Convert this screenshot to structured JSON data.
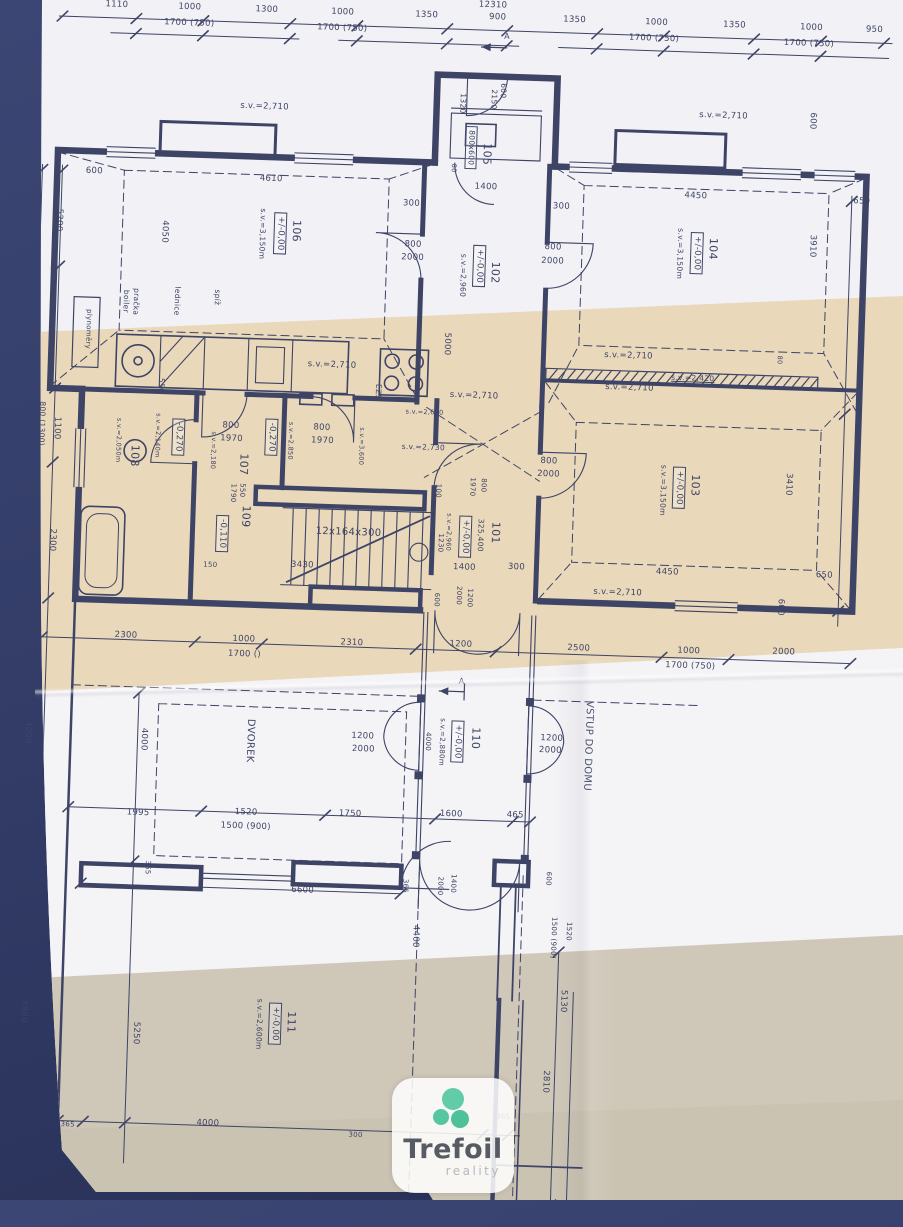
{
  "photo": {
    "background_color": "#333d68",
    "paper_color": "#f2f1f5",
    "tan_band_color": "#e9d8ba",
    "lower_band_color": "#cfc7b8",
    "ink_color": "#3e4466"
  },
  "logo": {
    "name": "Trefoil",
    "subtitle": "reality",
    "icon": "trefoil-clover-icon",
    "brand_green": "#57c8a1",
    "text_color": "#575b63",
    "subtitle_color": "#b5b8bd"
  },
  "plan": {
    "rooms": [
      {
        "number": "101",
        "level": "+/-0,00",
        "ceiling": "s.v.=2,960",
        "note": "325,400"
      },
      {
        "number": "102",
        "level": "+/-0,00",
        "ceiling": "s.v.=2,960"
      },
      {
        "number": "103",
        "level": "+/-0,00",
        "ceiling": "s.v.=3,150m"
      },
      {
        "number": "104",
        "level": "+/-0,00",
        "ceiling": "s.v.=3,150m"
      },
      {
        "number": "105",
        "fixture": "800x600"
      },
      {
        "number": "106",
        "level": "+/-0,00",
        "ceiling": "s.v.=3,150m",
        "features": [
          "boiler",
          "pračka",
          "lednice",
          "spíž"
        ]
      },
      {
        "number": "107",
        "level": "-0,270",
        "ceiling": "s.v.=2,850"
      },
      {
        "number": "108",
        "level": "-0,270",
        "ceiling": "s.v.=2,050m"
      },
      {
        "number": "109",
        "level": "-0,110",
        "stairs": "12x164x300"
      },
      {
        "number": "110",
        "level": "+/-0,00",
        "ceiling": "s.v.=2,880m"
      },
      {
        "number": "111",
        "level": "+/-0,00",
        "ceiling": "s.v.=2,600m"
      }
    ],
    "annotations": {
      "courtyard": "DVOREK",
      "entrance": "VSTUP DO DOMU",
      "gas_meters": "plynoměry",
      "alarm": "EZS",
      "stairs_formula": "12x164x300",
      "section_mark": "A",
      "total_width": "12310"
    },
    "labels": [
      {
        "t": "12310",
        "x": 493,
        "y": -9
      },
      {
        "t": "1110",
        "x": 117,
        "y": 3
      },
      {
        "t": "1000",
        "x": 190,
        "y": 3
      },
      {
        "t": "1300",
        "x": 267,
        "y": 3
      },
      {
        "t": "1000",
        "x": 343,
        "y": 3
      },
      {
        "t": "1350",
        "x": 427,
        "y": 3
      },
      {
        "t": "900",
        "x": 498,
        "y": 3
      },
      {
        "t": "1350",
        "x": 575,
        "y": 3
      },
      {
        "t": "1000",
        "x": 657,
        "y": 3
      },
      {
        "t": "1350",
        "x": 735,
        "y": 3
      },
      {
        "t": "1000",
        "x": 812,
        "y": 3
      },
      {
        "t": "950",
        "x": 875,
        "y": 3
      },
      {
        "t": "1700 (750)",
        "x": 190,
        "y": 19
      },
      {
        "t": "1700 (750)",
        "x": 343,
        "y": 19
      },
      {
        "t": "1700 (750)",
        "x": 655,
        "y": 19
      },
      {
        "t": "1700 (750)",
        "x": 810,
        "y": 19
      },
      {
        "t": "A",
        "x": 508,
        "y": 22,
        "s": 8
      },
      {
        "t": "600",
        "x": 100,
        "y": 170
      },
      {
        "t": "5200",
        "x": 66,
        "y": 220,
        "r": 1
      },
      {
        "t": "8600",
        "x": 45,
        "y": 337,
        "r": 1
      },
      {
        "t": "plynoměry",
        "x": 99,
        "y": 328,
        "r": 1,
        "s": 7
      },
      {
        "t": "800 (1300)",
        "x": 56,
        "y": 424,
        "r": 1,
        "s": 7.5
      },
      {
        "t": "1100",
        "x": 71,
        "y": 428,
        "r": 1
      },
      {
        "t": "2300",
        "x": 70,
        "y": 540,
        "r": 1
      },
      {
        "t": "4000",
        "x": 52,
        "y": 733,
        "r": 1
      },
      {
        "t": "5980",
        "x": 57,
        "y": 1012,
        "r": 1
      },
      {
        "t": "4000",
        "x": 168,
        "y": 736,
        "r": 1
      },
      {
        "t": "5250",
        "x": 170,
        "y": 1030,
        "r": 1
      },
      {
        "t": "s.v.=2,710",
        "x": 268,
        "y": 100
      },
      {
        "t": "4610",
        "x": 277,
        "y": 172
      },
      {
        "t": "106",
        "x": 304,
        "y": 223,
        "r": 1,
        "s": 11
      },
      {
        "t": "+/-0,00",
        "x": 288,
        "y": 226,
        "r": 1,
        "b": 1
      },
      {
        "t": "s.v.=3,150m",
        "x": 270,
        "y": 227,
        "r": 1,
        "s": 7.5
      },
      {
        "t": "4050",
        "x": 172,
        "y": 228,
        "r": 1
      },
      {
        "t": "300",
        "x": 418,
        "y": 192
      },
      {
        "t": "800",
        "x": 421,
        "y": 233
      },
      {
        "t": "2000",
        "x": 421,
        "y": 246
      },
      {
        "t": "boiler",
        "x": 136,
        "y": 299,
        "r": 1,
        "s": 7.5
      },
      {
        "t": "pračka",
        "x": 146,
        "y": 299,
        "r": 1,
        "s": 7.5
      },
      {
        "t": "lednice",
        "x": 187,
        "y": 297,
        "r": 1,
        "s": 7.5
      },
      {
        "t": "spíž",
        "x": 227,
        "y": 292,
        "r": 1,
        "s": 7.5
      },
      {
        "t": "600",
        "x": 506,
        "y": 76,
        "r": 1,
        "s": 7.5
      },
      {
        "t": "2150",
        "x": 497,
        "y": 85,
        "r": 1,
        "s": 7.5
      },
      {
        "t": "1320",
        "x": 466,
        "y": 90,
        "r": 1,
        "s": 7.5
      },
      {
        "t": "800x600",
        "x": 476,
        "y": 134,
        "r": 1,
        "b": 1,
        "s": 7.5
      },
      {
        "t": "105",
        "x": 492,
        "y": 140,
        "r": 1,
        "s": 11
      },
      {
        "t": "80",
        "x": 459,
        "y": 155,
        "r": 1,
        "s": 6.5
      },
      {
        "t": "1400",
        "x": 492,
        "y": 173
      },
      {
        "t": "300",
        "x": 568,
        "y": 190
      },
      {
        "t": "800",
        "x": 561,
        "y": 231
      },
      {
        "t": "2000",
        "x": 561,
        "y": 245
      },
      {
        "t": "102",
        "x": 504,
        "y": 258,
        "r": 1,
        "s": 11
      },
      {
        "t": "+/-0,00",
        "x": 488,
        "y": 252,
        "r": 1,
        "b": 1
      },
      {
        "t": "s.v.=2,960",
        "x": 472,
        "y": 262,
        "r": 1,
        "s": 7.5
      },
      {
        "t": "s.v.=2,710",
        "x": 727,
        "y": 94
      },
      {
        "t": "600",
        "x": 816,
        "y": 96,
        "r": 1
      },
      {
        "t": "4450",
        "x": 702,
        "y": 175
      },
      {
        "t": "650",
        "x": 868,
        "y": 175
      },
      {
        "t": "3910",
        "x": 820,
        "y": 221,
        "r": 1
      },
      {
        "t": "104",
        "x": 721,
        "y": 227,
        "r": 1,
        "s": 11
      },
      {
        "t": "+/-0,00",
        "x": 705,
        "y": 232,
        "r": 1,
        "b": 1
      },
      {
        "t": "s.v.=3,150m",
        "x": 688,
        "y": 233,
        "r": 1,
        "s": 7.5
      },
      {
        "t": "5000",
        "x": 458,
        "y": 331,
        "r": 1
      },
      {
        "t": "s.v.=2,710",
        "x": 344,
        "y": 356
      },
      {
        "t": "550",
        "x": 174,
        "y": 382,
        "r": 1,
        "s": 7.5
      },
      {
        "t": "EZS",
        "x": 391,
        "y": 381,
        "r": 1,
        "s": 7.5
      },
      {
        "t": "s.v.=2,710",
        "x": 487,
        "y": 382
      },
      {
        "t": "s.v.=2,650",
        "x": 438,
        "y": 400,
        "s": 6.5
      },
      {
        "t": "s.v.=2,730",
        "x": 438,
        "y": 435,
        "s": 7.5
      },
      {
        "t": "108",
        "x": 150,
        "y": 453,
        "r": 1,
        "s": 11
      },
      {
        "t": "s.v.=2,050m",
        "x": 133,
        "y": 438,
        "r": 1,
        "s": 6.5
      },
      {
        "t": "s.v.=2,140m",
        "x": 172,
        "y": 432,
        "r": 1,
        "s": 6.5
      },
      {
        "t": "-0,270",
        "x": 193,
        "y": 433,
        "r": 1,
        "b": 1
      },
      {
        "t": "800",
        "x": 245,
        "y": 420
      },
      {
        "t": "1970",
        "x": 246,
        "y": 433
      },
      {
        "t": "s.v.=2,180",
        "x": 228,
        "y": 445,
        "r": 1,
        "s": 6.5
      },
      {
        "t": "107",
        "x": 259,
        "y": 458,
        "r": 1,
        "s": 11
      },
      {
        "t": "-0,270",
        "x": 286,
        "y": 430,
        "r": 1,
        "b": 1
      },
      {
        "t": "s.v.=2,850",
        "x": 305,
        "y": 433,
        "r": 1,
        "s": 6.5
      },
      {
        "t": "800",
        "x": 336,
        "y": 419
      },
      {
        "t": "1970",
        "x": 337,
        "y": 432
      },
      {
        "t": "s.v.=3,600",
        "x": 376,
        "y": 436,
        "r": 1,
        "s": 6.5
      },
      {
        "t": "550",
        "x": 258,
        "y": 484,
        "r": 1,
        "s": 7
      },
      {
        "t": "1790",
        "x": 249,
        "y": 487,
        "r": 1,
        "s": 7
      },
      {
        "t": "109",
        "x": 263,
        "y": 510,
        "r": 1,
        "s": 11
      },
      {
        "t": "-0,110",
        "x": 240,
        "y": 528,
        "r": 1,
        "b": 1
      },
      {
        "t": "150",
        "x": 229,
        "y": 560,
        "s": 7
      },
      {
        "t": "12x164x300",
        "x": 366,
        "y": 523,
        "s": 10
      },
      {
        "t": "3430",
        "x": 321,
        "y": 557
      },
      {
        "t": "100",
        "x": 454,
        "y": 478,
        "r": 1,
        "s": 7
      },
      {
        "t": "800",
        "x": 499,
        "y": 471,
        "r": 1,
        "s": 7
      },
      {
        "t": "1970",
        "x": 488,
        "y": 473,
        "r": 1,
        "s": 7
      },
      {
        "t": "s.v.=2,960",
        "x": 466,
        "y": 519,
        "r": 1,
        "s": 6.5
      },
      {
        "t": "1230",
        "x": 458,
        "y": 530,
        "r": 1,
        "s": 7
      },
      {
        "t": "101",
        "x": 513,
        "y": 518,
        "r": 1,
        "s": 11
      },
      {
        "t": "325,400",
        "x": 498,
        "y": 521,
        "r": 1,
        "s": 7.5
      },
      {
        "t": "+/-0,00",
        "x": 483,
        "y": 523,
        "r": 1,
        "b": 1
      },
      {
        "t": "1400",
        "x": 483,
        "y": 554
      },
      {
        "t": "300",
        "x": 535,
        "y": 552
      },
      {
        "t": "600",
        "x": 456,
        "y": 587,
        "r": 1,
        "s": 7
      },
      {
        "t": "1200",
        "x": 489,
        "y": 584,
        "r": 1,
        "s": 7
      },
      {
        "t": "2000",
        "x": 478,
        "y": 582,
        "r": 1,
        "s": 7
      },
      {
        "t": "800",
        "x": 564,
        "y": 445
      },
      {
        "t": "2000",
        "x": 564,
        "y": 458
      },
      {
        "t": "s.v.=2,710",
        "x": 640,
        "y": 337
      },
      {
        "t": "s.v.=2,420",
        "x": 705,
        "y": 357,
        "s": 7.5,
        "u": 1
      },
      {
        "t": "s.v.=2,710",
        "x": 642,
        "y": 369
      },
      {
        "t": "80",
        "x": 791,
        "y": 336,
        "r": 1,
        "s": 6.5
      },
      {
        "t": "3410",
        "x": 804,
        "y": 460,
        "r": 1
      },
      {
        "t": "103",
        "x": 711,
        "y": 464,
        "r": 1,
        "s": 11
      },
      {
        "t": "+/-0,00",
        "x": 695,
        "y": 467,
        "r": 1,
        "b": 1
      },
      {
        "t": "s.v.=3,150m",
        "x": 679,
        "y": 470,
        "r": 1,
        "s": 7.5
      },
      {
        "t": "4450",
        "x": 686,
        "y": 552
      },
      {
        "t": "650",
        "x": 843,
        "y": 550
      },
      {
        "t": "600",
        "x": 800,
        "y": 583,
        "r": 1
      },
      {
        "t": "s.v.=2,710",
        "x": 637,
        "y": 574
      },
      {
        "t": "2300",
        "x": 147,
        "y": 633
      },
      {
        "t": "1000",
        "x": 265,
        "y": 633
      },
      {
        "t": "1700 ()",
        "x": 266,
        "y": 648
      },
      {
        "t": "2310",
        "x": 373,
        "y": 633
      },
      {
        "t": "1200",
        "x": 482,
        "y": 631
      },
      {
        "t": "2500",
        "x": 600,
        "y": 631
      },
      {
        "t": "1000",
        "x": 710,
        "y": 630
      },
      {
        "t": "1700 (750)",
        "x": 712,
        "y": 645
      },
      {
        "t": "2000",
        "x": 805,
        "y": 628
      },
      {
        "t": "A",
        "x": 484,
        "y": 668,
        "s": 8
      },
      {
        "t": "1200",
        "x": 387,
        "y": 726
      },
      {
        "t": "2000",
        "x": 388,
        "y": 739
      },
      {
        "t": "1200",
        "x": 576,
        "y": 722
      },
      {
        "t": "2000",
        "x": 575,
        "y": 734
      },
      {
        "t": "110",
        "x": 500,
        "y": 724,
        "r": 1,
        "s": 11
      },
      {
        "t": "+/-0,00",
        "x": 482,
        "y": 728,
        "r": 1,
        "b": 1
      },
      {
        "t": "s.v.=2,880m",
        "x": 466,
        "y": 729,
        "r": 1,
        "s": 7
      },
      {
        "t": "4000",
        "x": 452,
        "y": 729,
        "r": 1,
        "s": 7
      },
      {
        "t": "DVOREK",
        "x": 274,
        "y": 734,
        "r": 1,
        "s": 10
      },
      {
        "t": "VSTUP DO DOMU",
        "x": 612,
        "y": 728,
        "r": 1,
        "s": 10
      },
      {
        "t": "1995",
        "x": 165,
        "y": 810
      },
      {
        "t": "1520",
        "x": 273,
        "y": 806
      },
      {
        "t": "1500 (900)",
        "x": 273,
        "y": 820
      },
      {
        "t": "1750",
        "x": 377,
        "y": 804
      },
      {
        "t": "1600",
        "x": 478,
        "y": 801
      },
      {
        "t": "465",
        "x": 542,
        "y": 800
      },
      {
        "t": "6600",
        "x": 332,
        "y": 882
      },
      {
        "t": "365",
        "x": 176,
        "y": 864,
        "r": 1,
        "s": 7
      },
      {
        "t": "365",
        "x": 434,
        "y": 874,
        "r": 1,
        "s": 7
      },
      {
        "t": "1400",
        "x": 482,
        "y": 870,
        "r": 1,
        "s": 7
      },
      {
        "t": "2000",
        "x": 469,
        "y": 873,
        "r": 1,
        "s": 7
      },
      {
        "t": "600",
        "x": 577,
        "y": 862,
        "r": 1,
        "s": 7
      },
      {
        "t": "4400",
        "x": 446,
        "y": 924,
        "r": 1
      },
      {
        "t": "1520",
        "x": 599,
        "y": 914,
        "r": 1,
        "s": 7
      },
      {
        "t": "1500 (900)",
        "x": 584,
        "y": 921,
        "r": 1,
        "s": 7
      },
      {
        "t": "5130",
        "x": 596,
        "y": 984,
        "r": 1
      },
      {
        "t": "2810",
        "x": 581,
        "y": 1065,
        "r": 1
      },
      {
        "t": "111",
        "x": 325,
        "y": 1014,
        "r": 1,
        "s": 11
      },
      {
        "t": "+/-0,00",
        "x": 309,
        "y": 1016,
        "r": 1,
        "b": 1
      },
      {
        "t": "s.v.=2,600m",
        "x": 293,
        "y": 1017,
        "r": 1,
        "s": 7.5
      },
      {
        "t": "365",
        "x": 105,
        "y": 1124,
        "s": 7
      },
      {
        "t": "4000",
        "x": 245,
        "y": 1118
      },
      {
        "t": "365",
        "x": 540,
        "y": 1102,
        "s": 7
      },
      {
        "t": "300",
        "x": 393,
        "y": 1125,
        "s": 7
      }
    ]
  }
}
